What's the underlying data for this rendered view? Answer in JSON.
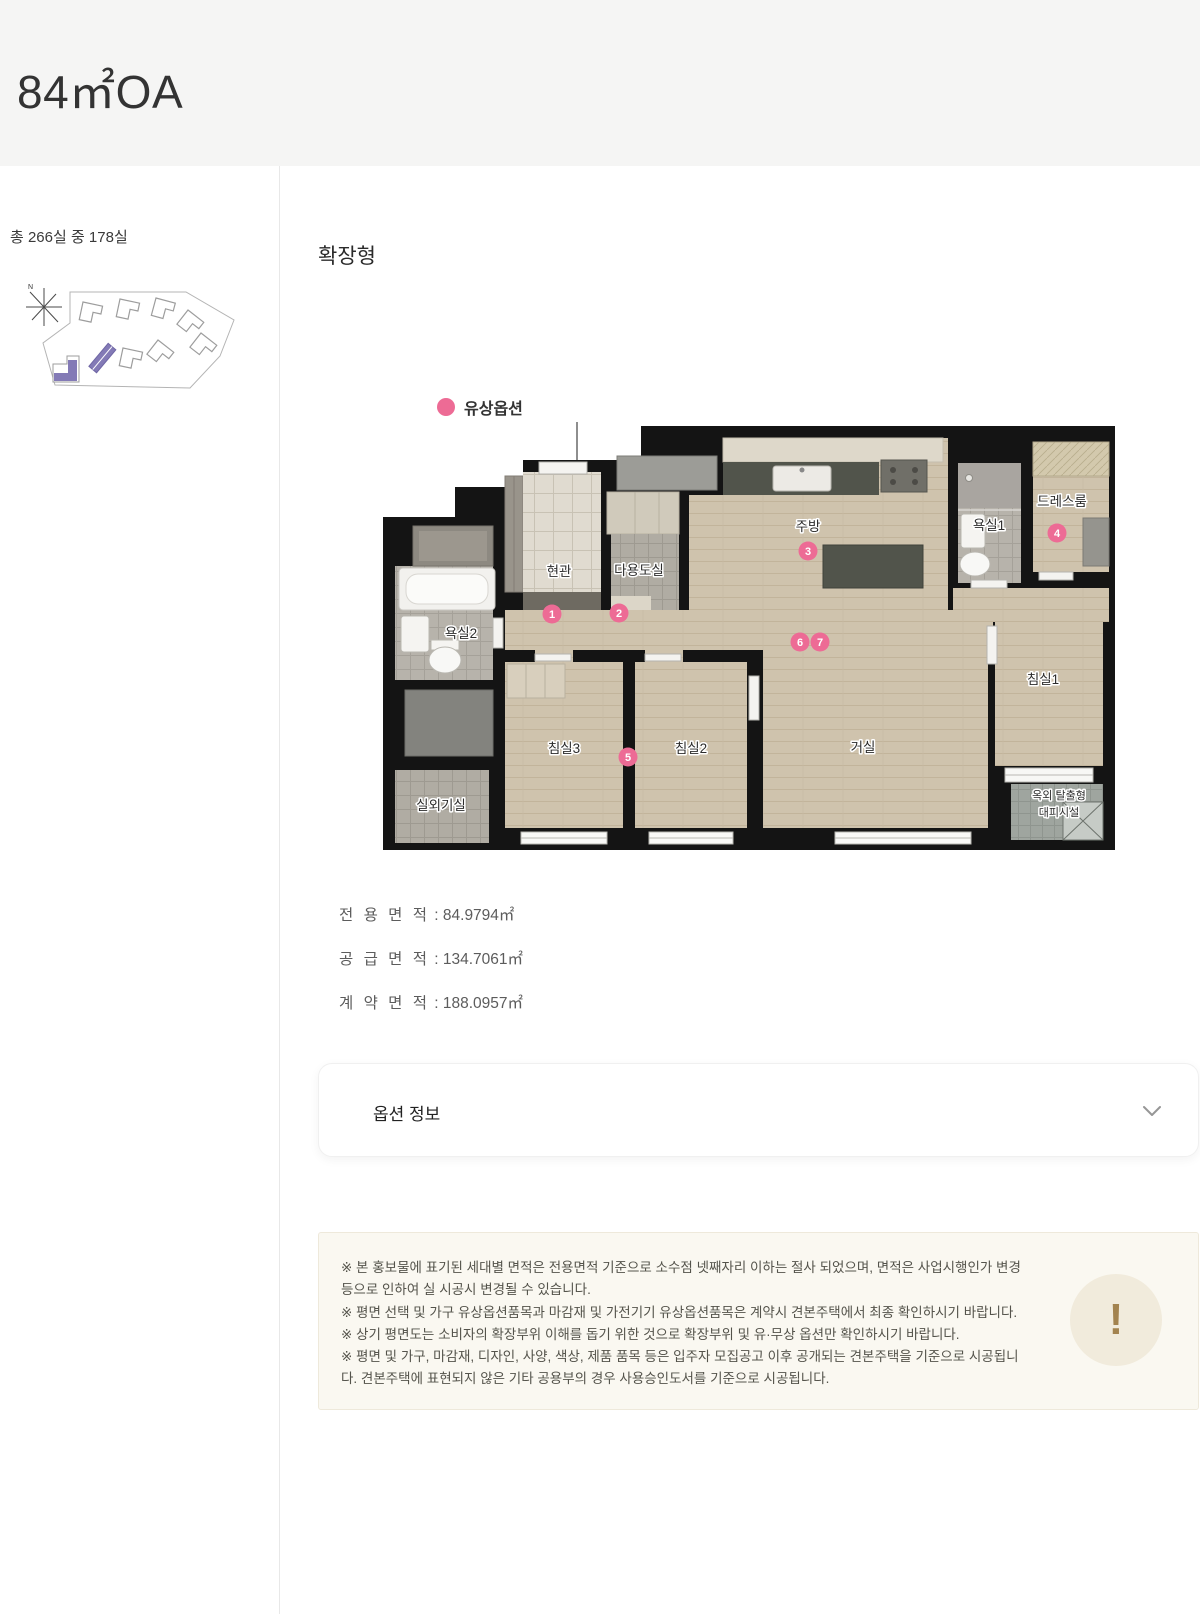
{
  "header": {
    "title": "84㎡OA"
  },
  "sidebar": {
    "availability": "총 266실 중 178실"
  },
  "main": {
    "plan_type_label": "확장형",
    "legend": {
      "label": "유상옵션"
    },
    "floor_plan": {
      "rooms": [
        "현관",
        "다용도실",
        "주방",
        "욕실1",
        "드레스룸",
        "욕실2",
        "침실3",
        "침실2",
        "거실",
        "침실1",
        "실외기실",
        "옥외 탈출형",
        "대피시설"
      ],
      "markers": [
        "1",
        "2",
        "3",
        "4",
        "5",
        "6",
        "7"
      ]
    },
    "areas": [
      {
        "label": "전 용 면 적",
        "value": ": 84.9794㎡"
      },
      {
        "label": "공 급 면 적",
        "value": ": 134.7061㎡"
      },
      {
        "label": "계 약 면 적",
        "value": ": 188.0957㎡"
      }
    ],
    "accordion": {
      "label": "옵션 정보"
    },
    "notice": {
      "icon": "!",
      "items": [
        "※ 본 홍보물에 표기된 세대별 면적은 전용면적 기준으로 소수점 넷째자리 이하는 절사 되었으며, 면적은 사업시행인가 변경 등으로 인하여 실 시공시 변경될 수 있습니다.",
        "※ 평면 선택 및 가구 유상옵션품목과 마감재 및 가전기기 유상옵션품목은 계약시 견본주택에서 최종 확인하시기 바랍니다.",
        "※ 상기 평면도는 소비자의 확장부위 이해를 돕기 위한 것으로 확장부위 및 유·무상 옵션만 확인하시기 바랍니다.",
        "※ 평면 및 가구, 마감재, 디자인, 사양, 색상, 제품 품목 등은 입주자 모집공고 이후 공개되는 견본주택을 기준으로 시공됩니다. 견본주택에 표현되지 않은 기타 공용부의 경우 사용승인도서를 기준으로 시공됩니다."
      ]
    }
  },
  "colors": {
    "accent_pink": "#ed6b95",
    "header_bg": "#f5f5f4",
    "notice_bg": "#faf8f1",
    "badge_bg": "#f1ebdc",
    "badge_fg": "#a3834f",
    "site_highlight": "#837ab6"
  }
}
